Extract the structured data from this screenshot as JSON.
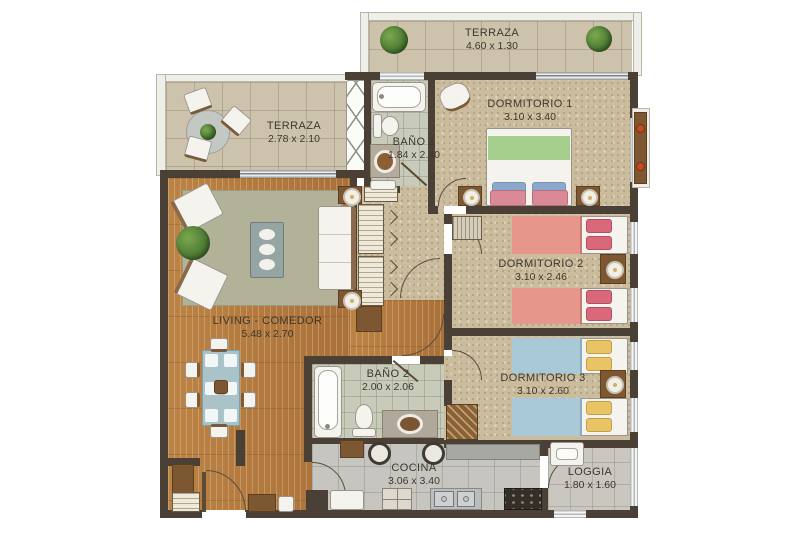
{
  "plan": {
    "type": "apartment-floor-plan",
    "rooms": {
      "terraza_top": {
        "name": "TERRAZA",
        "dims": "4.60 x 1.30"
      },
      "terraza_left": {
        "name": "TERRAZA",
        "dims": "2.78 x 2.10"
      },
      "dormitorio1": {
        "name": "DORMITORIO 1",
        "dims": "3.10 x 3.40"
      },
      "bano1": {
        "name": "BAÑO 1",
        "dims": "1.84 x 2.40"
      },
      "dormitorio2": {
        "name": "DORMITORIO 2",
        "dims": "3.10 x 2.46"
      },
      "dormitorio3": {
        "name": "DORMITORIO 3",
        "dims": "3.10 x 2.60"
      },
      "living": {
        "name": "LIVING - COMEDOR",
        "dims": "5.48 x 2.70"
      },
      "bano2": {
        "name": "BAÑO 2",
        "dims": "2.00 x 2.06"
      },
      "cocina": {
        "name": "COCINA",
        "dims": "3.06 x 3.40"
      },
      "loggia": {
        "name": "LOGGIA",
        "dims": "1.80 x 1.60"
      }
    },
    "colors": {
      "wall": "#4b4036",
      "wood_floor": "#b17a3e",
      "carpet": "#cbbc9e",
      "terrace_tile": "#cdc2ac",
      "bath_tile": "#c9cbba",
      "kitchen_tile": "#c6c5c0",
      "rug": "#b1b298",
      "bed_green": "#a5cd8c",
      "bed_salmon": "#e6968b",
      "bed_blue": "#a9c9d6",
      "pillow_yellow": "#e8c464",
      "pillow_pink": "#d9687a",
      "pillow_blue": "#8ba9cd",
      "plant_green": "#5c8e3f",
      "label_text": "#3e382e"
    }
  }
}
